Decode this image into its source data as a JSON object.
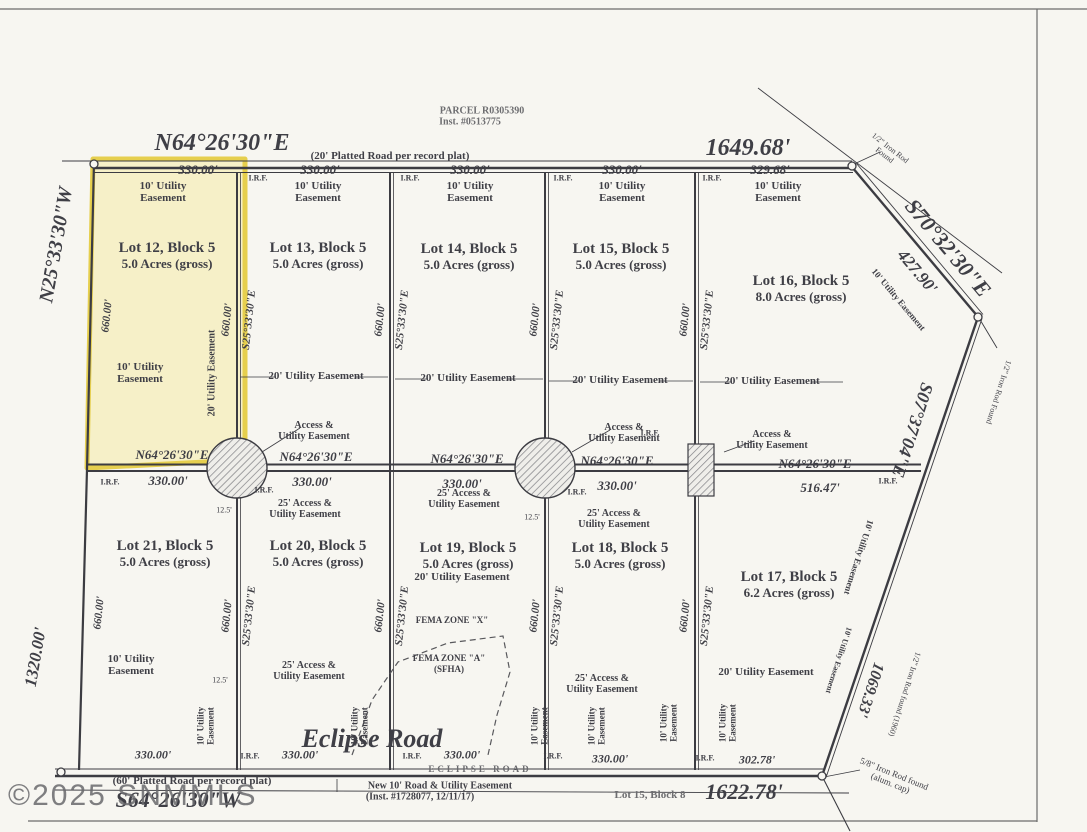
{
  "watermark": "©2025 SNMMLS",
  "parcel": {
    "l1": "PARCEL R0305390",
    "l2": "Inst. #0513775"
  },
  "dims": {
    "d330": "330.00'",
    "d32968": "329.68'",
    "d660": "660.00'",
    "d1320": "1320.00'",
    "d164968": "1649.68'",
    "d42790": "427.90'",
    "d106933": "1069.33'",
    "d162278": "1622.78'",
    "d51647": "516.47'",
    "d30278": "302.78'",
    "d125": "12.5'"
  },
  "bearings": {
    "n64": "N64°26'30\"E",
    "s64": "S64°26'30\"W",
    "s25": "S25°33'30\"E",
    "n25": "N25°33'30\"W",
    "s70": "S70°32'30\"E",
    "s07": "S07°37'04\"E"
  },
  "roads": {
    "eclipse": "Eclipse Road",
    "eclipse_stamp": "ECLIPSE ROAD",
    "north_note": "(20' Platted Road per record plat)",
    "south_note": "(60' Platted Road per record plat)",
    "new_road_l1": "New 10' Road & Utility Easement",
    "new_road_l2": "(Inst. #1728077, 12/11/17)"
  },
  "lots": {
    "lot12": {
      "name": "Lot 12, Block 5",
      "acres": "5.0 Acres (gross)"
    },
    "lot13": {
      "name": "Lot 13, Block 5",
      "acres": "5.0 Acres (gross)"
    },
    "lot14": {
      "name": "Lot 14, Block 5",
      "acres": "5.0 Acres (gross)"
    },
    "lot15": {
      "name": "Lot 15, Block 5",
      "acres": "5.0 Acres (gross)"
    },
    "lot16": {
      "name": "Lot 16, Block 5",
      "acres": "8.0 Acres (gross)"
    },
    "lot17": {
      "name": "Lot 17, Block 5",
      "acres": "6.2 Acres (gross)"
    },
    "lot18": {
      "name": "Lot 18, Block 5",
      "acres": "5.0 Acres (gross)"
    },
    "lot19": {
      "name": "Lot 19, Block 5",
      "acres": "5.0 Acres (gross)"
    },
    "lot20": {
      "name": "Lot 20, Block 5",
      "acres": "5.0 Acres (gross)"
    },
    "lot21": {
      "name": "Lot 21, Block 5",
      "acres": "5.0 Acres (gross)"
    },
    "adjacent": "Lot 15, Block 8"
  },
  "easements": {
    "u10a": "10' Utility",
    "u10b": "Easement",
    "u10": "10' Utility Easement",
    "u20": "20' Utility Easement",
    "a25a": "25' Access &",
    "a25b": "Utility Easement",
    "aua": "Access &",
    "aub": "Utility Easement"
  },
  "monuments": {
    "irf": "I.R.F.",
    "rod12a": "1/2\" Iron Rod",
    "rod12b": "Found",
    "rod12": "1/2\" Iron Rod Found",
    "rod1960": "1/2\" Iron Rod found (1960)",
    "rod58a": "5/8\" Iron Rod found",
    "rod58b": "(alum. cap)"
  },
  "fema": {
    "x": "FEMA ZONE \"X\"",
    "a": "FEMA ZONE \"A\"",
    "sfha": "(SFHA)"
  }
}
